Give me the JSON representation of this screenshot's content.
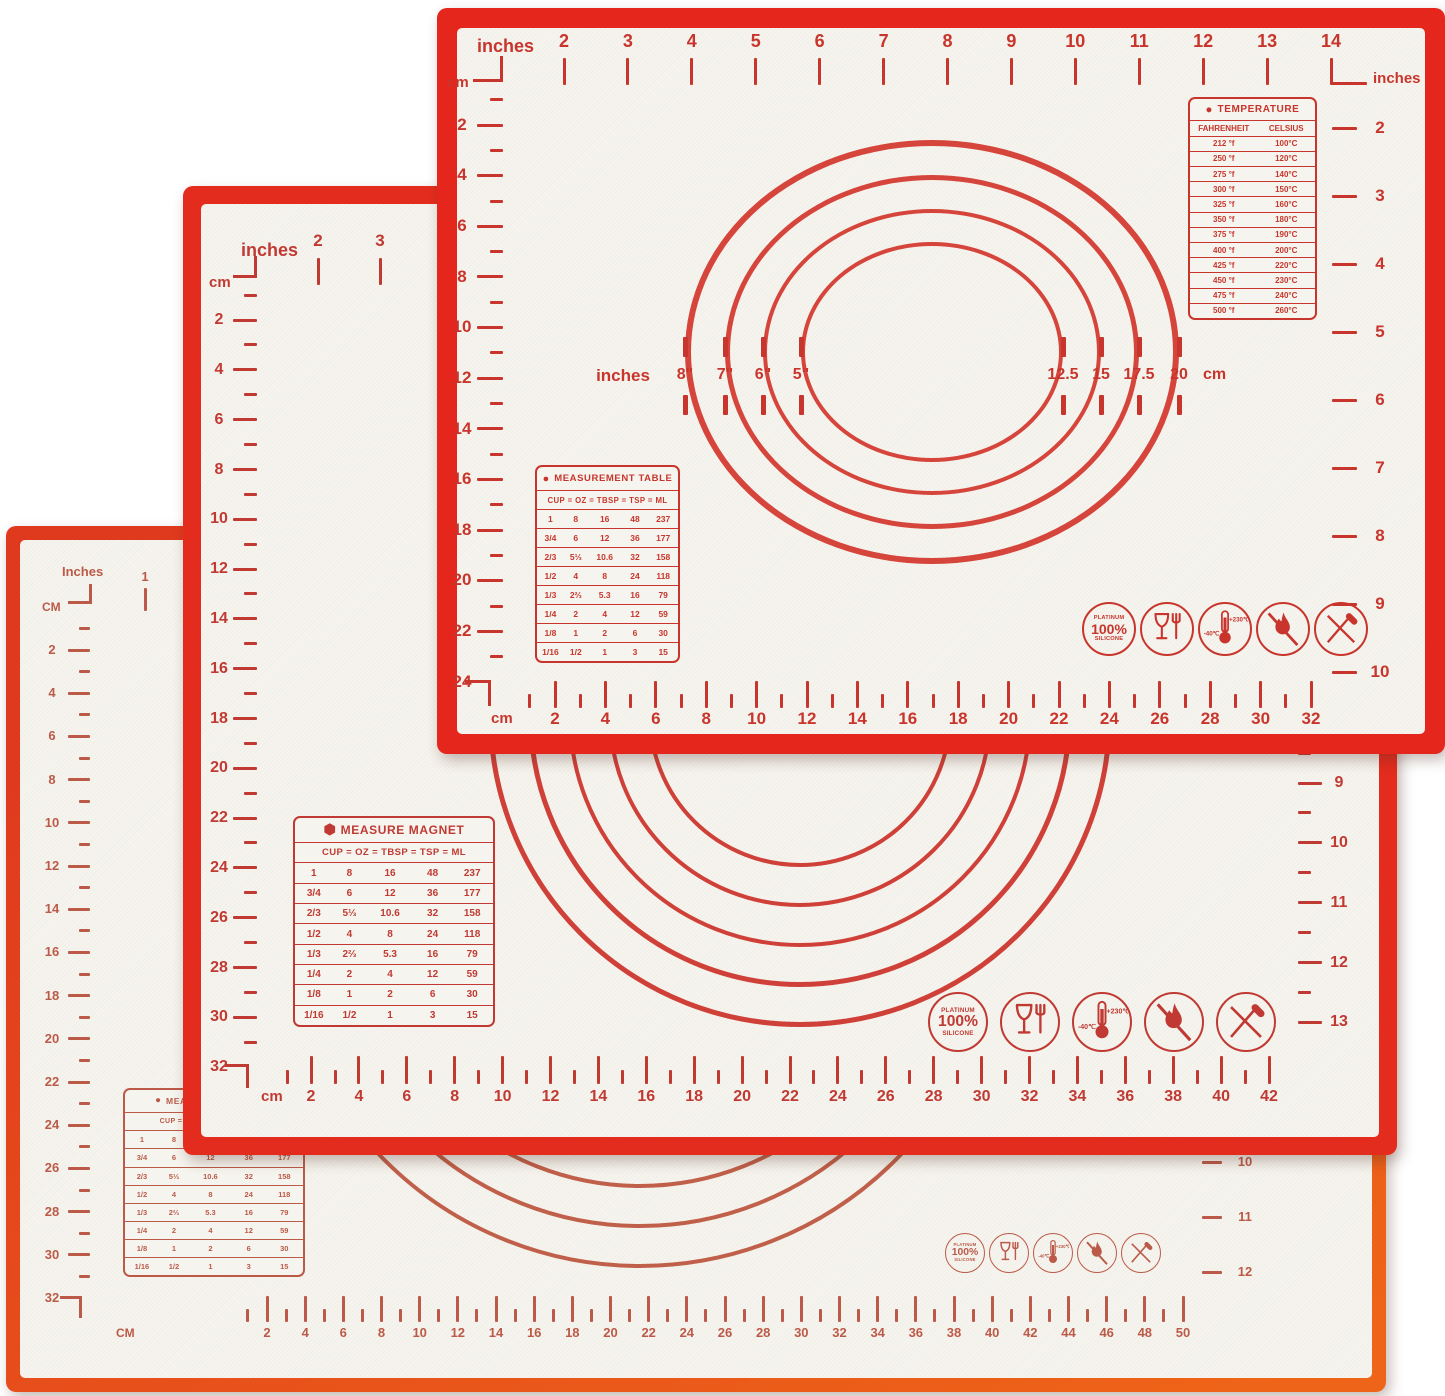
{
  "product": "3-piece silicone pastry baking mat set with measurements",
  "colors": {
    "mat1_border": "#e5261c",
    "mat2_border": "#e32c1e",
    "mat3_border": "#ee6418",
    "mat1_ink": "#c8352c",
    "mat2_ink": "#c03a33",
    "mat3_ink": "#bb5a48",
    "surface": "#f6f4ee"
  },
  "icons": {
    "names": [
      "platinum-silicone-icon",
      "food-grade-icon",
      "temperature-range-icon",
      "no-open-flame-icon",
      "no-knife-icon"
    ],
    "platinum_lines": [
      "PLATINUM",
      "100%",
      "SILICONE"
    ],
    "temp_min": "-40℃",
    "temp_max": "+230℃"
  },
  "mat1": {
    "rulers": {
      "top": {
        "unit_left": "inches",
        "unit_right": "inches",
        "numbers": [
          "2",
          "3",
          "4",
          "5",
          "6",
          "7",
          "8",
          "9",
          "10",
          "11",
          "12",
          "13",
          "14"
        ]
      },
      "left": {
        "unit": "cm",
        "numbers": [
          "2",
          "4",
          "6",
          "8",
          "10",
          "12",
          "14",
          "16",
          "18",
          "20",
          "22",
          "24"
        ]
      },
      "right": {
        "numbers": [
          "2",
          "3",
          "4",
          "5",
          "6",
          "7",
          "8",
          "9",
          "10"
        ]
      },
      "bottom": {
        "unit": "cm",
        "numbers": [
          "2",
          "4",
          "6",
          "8",
          "10",
          "12",
          "14",
          "16",
          "18",
          "20",
          "22",
          "24",
          "26",
          "28",
          "30",
          "32"
        ]
      }
    },
    "circle_labels": {
      "unit_left": "inches",
      "left": [
        "8\"",
        "7\"",
        "6\"",
        "5\""
      ],
      "right": [
        "12.5",
        "15",
        "17.5",
        "20"
      ],
      "unit_right": "cm"
    },
    "temperature_table": {
      "title": "TEMPERATURE",
      "headers": [
        "FAHRENHEIT",
        "CELSIUS"
      ],
      "rows": [
        [
          "212 °f",
          "100°C"
        ],
        [
          "250 °f",
          "120°C"
        ],
        [
          "275 °f",
          "140°C"
        ],
        [
          "300 °f",
          "150°C"
        ],
        [
          "325 °f",
          "160°C"
        ],
        [
          "350 °f",
          "180°C"
        ],
        [
          "375 °f",
          "190°C"
        ],
        [
          "400 °f",
          "200°C"
        ],
        [
          "425 °f",
          "220°C"
        ],
        [
          "450 °f",
          "230°C"
        ],
        [
          "475 °f",
          "240°C"
        ],
        [
          "500 °f",
          "260°C"
        ]
      ]
    },
    "measurement_table": {
      "title": "MEASUREMENT TABLE",
      "header": "CUP = OZ = TBSP = TSP = ML",
      "rows": [
        [
          "1",
          "8",
          "16",
          "48",
          "237"
        ],
        [
          "3/4",
          "6",
          "12",
          "36",
          "177"
        ],
        [
          "2/3",
          "5⅓",
          "10.6",
          "32",
          "158"
        ],
        [
          "1/2",
          "4",
          "8",
          "24",
          "118"
        ],
        [
          "1/3",
          "2⅔",
          "5.3",
          "16",
          "79"
        ],
        [
          "1/4",
          "2",
          "4",
          "12",
          "59"
        ],
        [
          "1/8",
          "1",
          "2",
          "6",
          "30"
        ],
        [
          "1/16",
          "1/2",
          "1",
          "3",
          "15"
        ]
      ]
    }
  },
  "mat2": {
    "rulers": {
      "top": {
        "unit": "inches",
        "numbers": [
          "2",
          "3"
        ]
      },
      "left": {
        "unit": "cm",
        "numbers": [
          "2",
          "4",
          "6",
          "8",
          "10",
          "12",
          "14",
          "16",
          "18",
          "20",
          "22",
          "24",
          "26",
          "28",
          "30",
          "32"
        ]
      },
      "right": {
        "numbers": [
          "9",
          "10",
          "11",
          "12",
          "13"
        ]
      },
      "bottom": {
        "unit": "cm",
        "numbers": [
          "2",
          "4",
          "6",
          "8",
          "10",
          "12",
          "14",
          "16",
          "18",
          "20",
          "22",
          "24",
          "26",
          "28",
          "30",
          "32",
          "34",
          "36",
          "38",
          "40",
          "42"
        ]
      }
    },
    "measurement_table": {
      "title": "MEASURE MAGNET",
      "header": "CUP = OZ = TBSP = TSP = ML",
      "rows": [
        [
          "1",
          "8",
          "16",
          "48",
          "237"
        ],
        [
          "3/4",
          "6",
          "12",
          "36",
          "177"
        ],
        [
          "2/3",
          "5⅓",
          "10.6",
          "32",
          "158"
        ],
        [
          "1/2",
          "4",
          "8",
          "24",
          "118"
        ],
        [
          "1/3",
          "2⅔",
          "5.3",
          "16",
          "79"
        ],
        [
          "1/4",
          "2",
          "4",
          "12",
          "59"
        ],
        [
          "1/8",
          "1",
          "2",
          "6",
          "30"
        ],
        [
          "1/16",
          "1/2",
          "1",
          "3",
          "15"
        ]
      ]
    }
  },
  "mat3": {
    "rulers": {
      "top": {
        "unit": "Inches",
        "numbers": [
          "1"
        ]
      },
      "left": {
        "unit": "CM",
        "numbers": [
          "2",
          "4",
          "6",
          "8",
          "10",
          "12",
          "14",
          "16",
          "18",
          "20",
          "22",
          "24",
          "26",
          "28",
          "30",
          "32"
        ]
      },
      "right": {
        "numbers": [
          "10",
          "11",
          "12"
        ]
      },
      "bottom": {
        "unit": "CM",
        "numbers": [
          "2",
          "4",
          "6",
          "8",
          "10",
          "12",
          "14",
          "16",
          "18",
          "20",
          "22",
          "24",
          "26",
          "28",
          "30",
          "32",
          "34",
          "36",
          "38",
          "40",
          "42",
          "44",
          "46",
          "48",
          "50"
        ]
      }
    },
    "measurement_table": {
      "title": "MEASUREMENT TABLE",
      "header": "CUP = OZ = TBSP = TSP = ML",
      "rows": [
        [
          "1",
          "8",
          "16",
          "48",
          "237"
        ],
        [
          "3/4",
          "6",
          "12",
          "36",
          "177"
        ],
        [
          "2/3",
          "5⅓",
          "10.6",
          "32",
          "158"
        ],
        [
          "1/2",
          "4",
          "8",
          "24",
          "118"
        ],
        [
          "1/3",
          "2⅔",
          "5.3",
          "16",
          "79"
        ],
        [
          "1/4",
          "2",
          "4",
          "12",
          "59"
        ],
        [
          "1/8",
          "1",
          "2",
          "6",
          "30"
        ],
        [
          "1/16",
          "1/2",
          "1",
          "3",
          "15"
        ]
      ]
    }
  }
}
